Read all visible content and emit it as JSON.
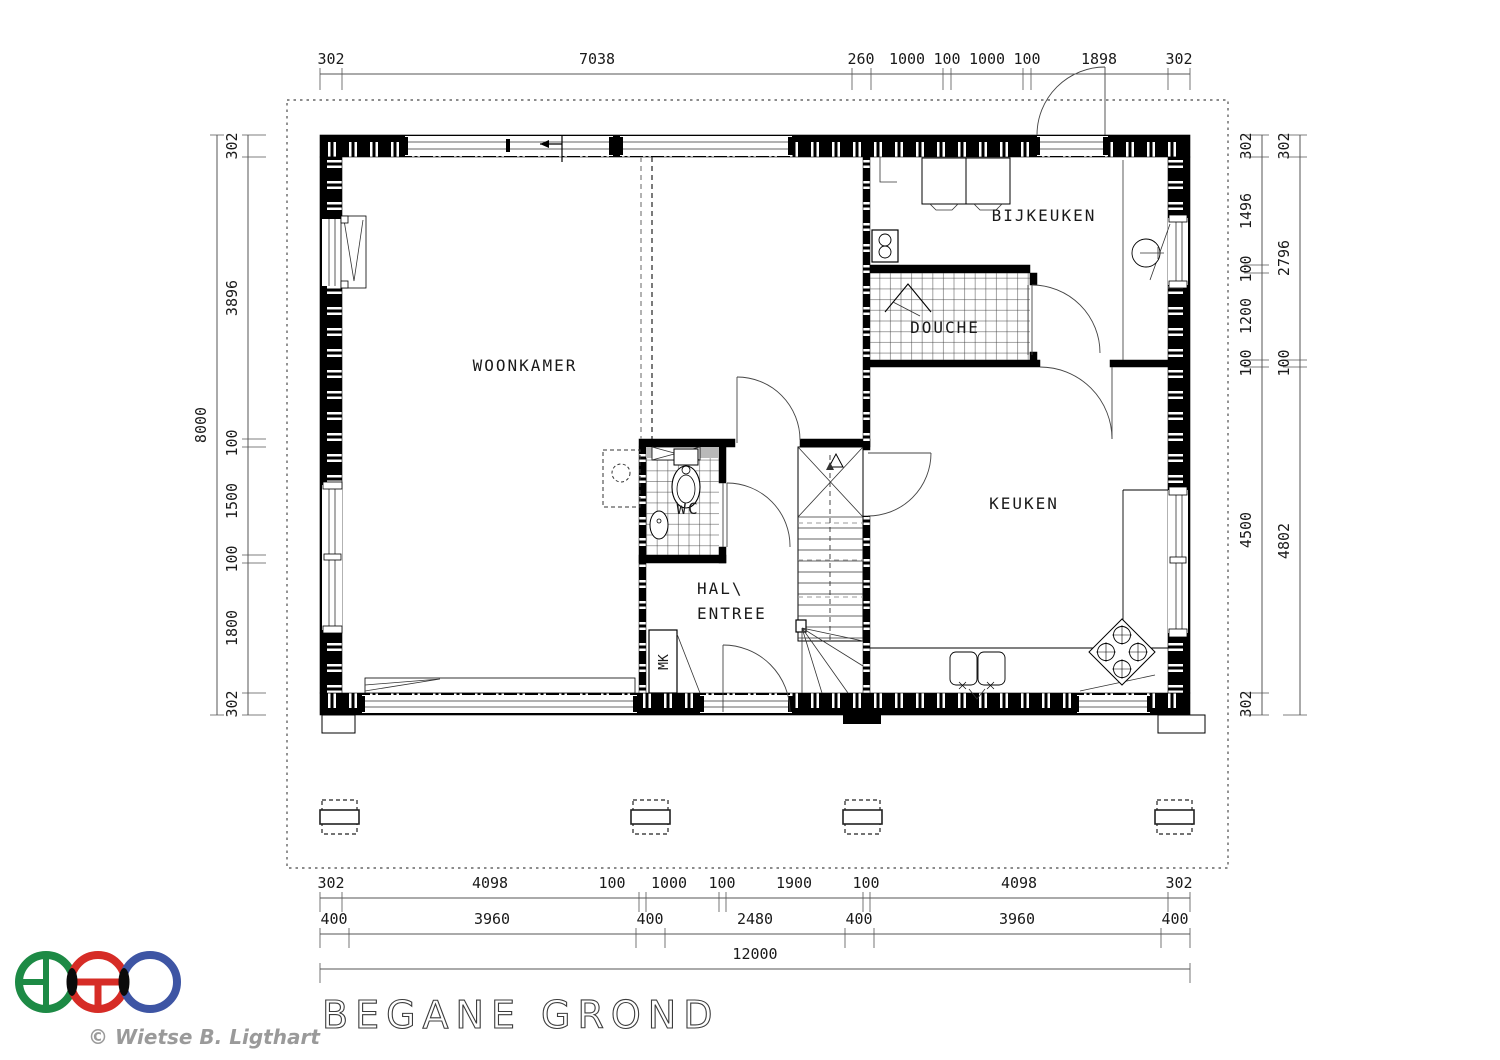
{
  "drawing": {
    "title": "BEGANE GROND",
    "copyright": "© Wietse B. Ligthart"
  },
  "rooms": {
    "woonkamer": "WOONKAMER",
    "bijkeuken": "BIJKEUKEN",
    "douche": "DOUCHE",
    "keuken": "KEUKEN",
    "wc": "WC",
    "hal_line1": "HAL\\",
    "hal_line2": "ENTREE",
    "mk": "MK"
  },
  "dimensions": {
    "top": [
      "302",
      "7038",
      "260",
      "1000",
      "100",
      "1000",
      "100",
      "1898",
      "302"
    ],
    "left_outer": "8000",
    "left_inner": [
      "302",
      "3896",
      "100",
      "1500",
      "100",
      "1800",
      "302"
    ],
    "right_inner": [
      "302",
      "1496",
      "100",
      "1200",
      "100",
      "4500",
      "302"
    ],
    "right_outer": [
      "302",
      "2796",
      "100",
      "4802"
    ],
    "bottom_row1": [
      "302",
      "4098",
      "100",
      "1000",
      "100",
      "1900",
      "100",
      "4098",
      "302"
    ],
    "bottom_row2": [
      "400",
      "3960",
      "400",
      "2480",
      "400",
      "3960",
      "400"
    ],
    "bottom_total": "12000"
  },
  "logo": {
    "green": "#1d8a45",
    "red": "#d62c26",
    "blue": "#3e55a4"
  }
}
